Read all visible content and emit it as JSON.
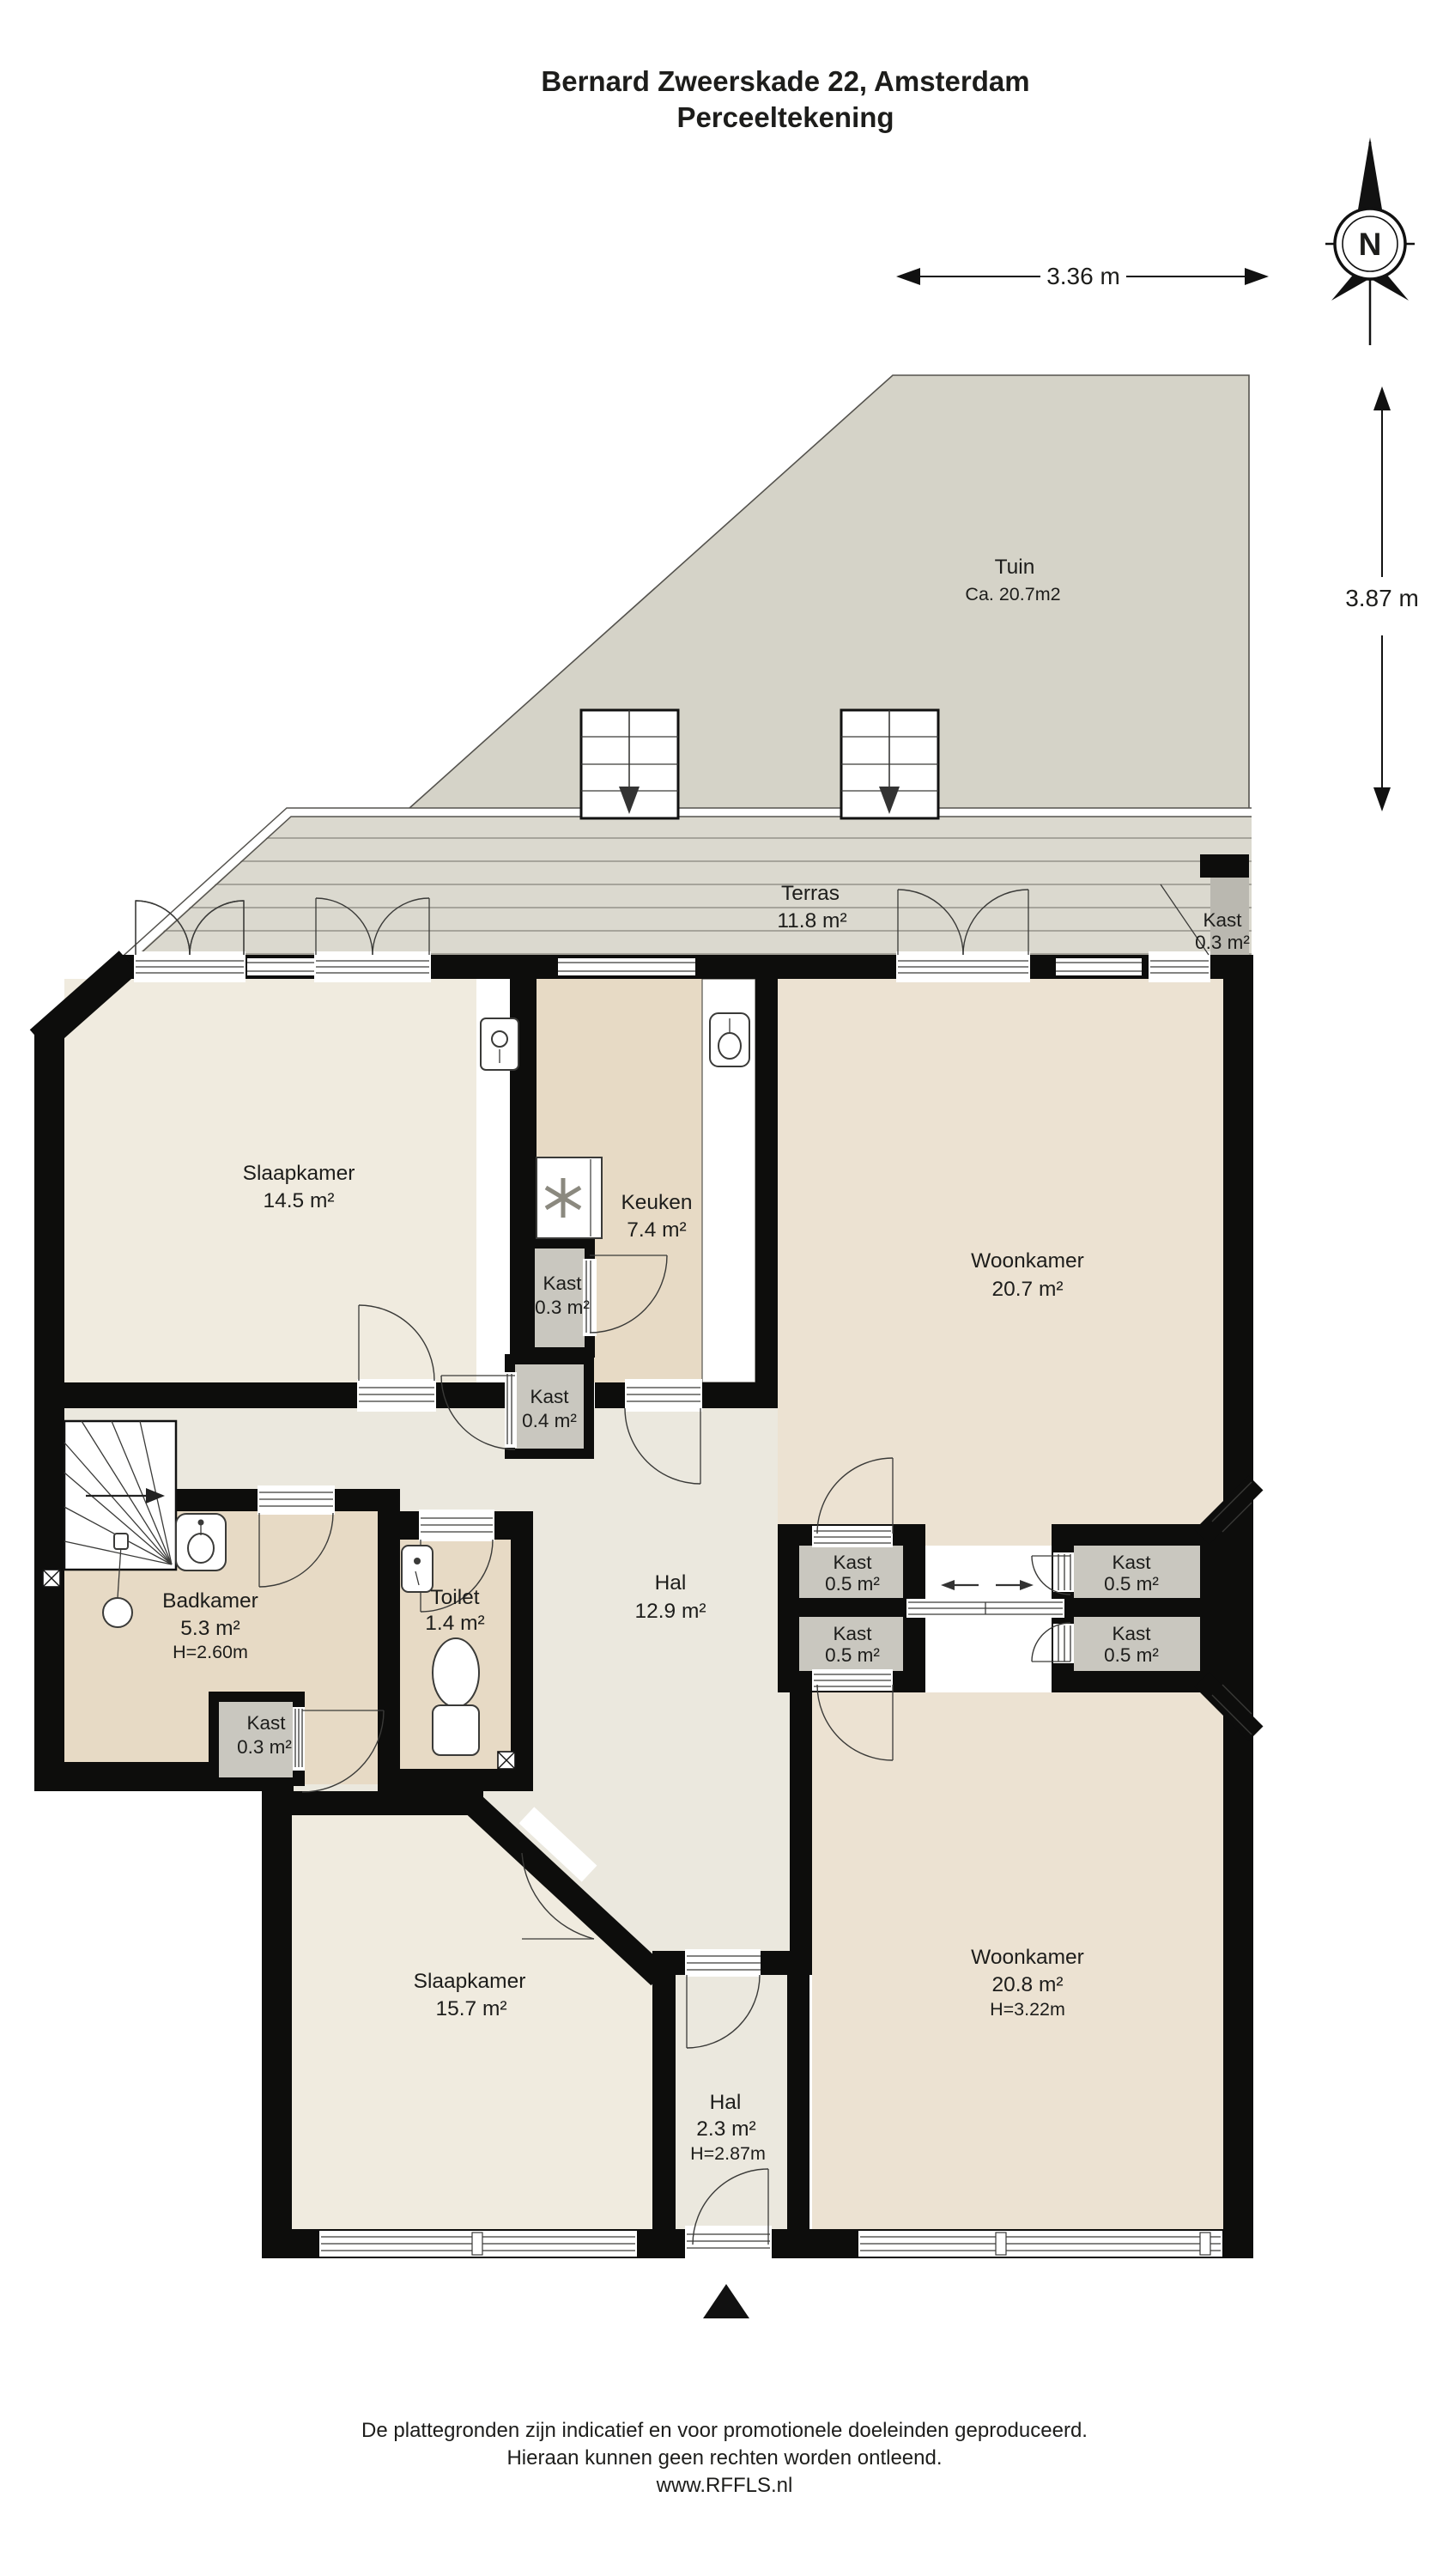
{
  "title": {
    "line1": "Bernard Zweerskade 22, Amsterdam",
    "line2": "Perceeltekening"
  },
  "compass": {
    "north_label": "N"
  },
  "dimensions": {
    "horizontal": "3.36 m",
    "vertical": "3.87 m"
  },
  "rooms": {
    "tuin": {
      "name": "Tuin",
      "area": "Ca. 20.7m2"
    },
    "terras": {
      "name": "Terras",
      "area": "11.8 m²"
    },
    "kast_terras": {
      "name": "Kast",
      "area": "0.3 m²"
    },
    "slaapkamer1": {
      "name": "Slaapkamer",
      "area": "14.5 m²"
    },
    "keuken": {
      "name": "Keuken",
      "area": "7.4 m²"
    },
    "woonkamer1": {
      "name": "Woonkamer",
      "area": "20.7 m²"
    },
    "kast_keuken": {
      "name": "Kast",
      "area": "0.3 m²"
    },
    "kast_hal": {
      "name": "Kast",
      "area": "0.4 m²"
    },
    "hal1": {
      "name": "Hal",
      "area": "12.9 m²"
    },
    "badkamer": {
      "name": "Badkamer",
      "area": "5.3 m²",
      "height": "H=2.60m"
    },
    "toilet": {
      "name": "Toilet",
      "area": "1.4 m²"
    },
    "kast_badkamer": {
      "name": "Kast",
      "area": "0.3 m²"
    },
    "kast_lt": {
      "name": "Kast",
      "area": "0.5 m²"
    },
    "kast_lb": {
      "name": "Kast",
      "area": "0.5 m²"
    },
    "kast_rt": {
      "name": "Kast",
      "area": "0.5 m²"
    },
    "kast_rb": {
      "name": "Kast",
      "area": "0.5 m²"
    },
    "slaapkamer2": {
      "name": "Slaapkamer",
      "area": "15.7 m²"
    },
    "hal2": {
      "name": "Hal",
      "area": "2.3 m²",
      "height": "H=2.87m"
    },
    "woonkamer2": {
      "name": "Woonkamer",
      "area": "20.8 m²",
      "height": "H=3.22m"
    }
  },
  "footer": {
    "line1": "De plattegronden zijn indicatief en voor promotionele doeleinden geproduceerd.",
    "line2": "Hieraan kunnen geen rechten worden ontleend.",
    "line3": "www.RFFLS.nl"
  },
  "colors": {
    "wall": "#0d0d0c",
    "cream": "#f0ebdf",
    "tan": "#e7dac5",
    "woon": "#ece2d2",
    "hal": "#ebe8de",
    "kast": "#c9c7bf",
    "tuin": "#d5d3c8",
    "terras": "#dbd9cf"
  }
}
